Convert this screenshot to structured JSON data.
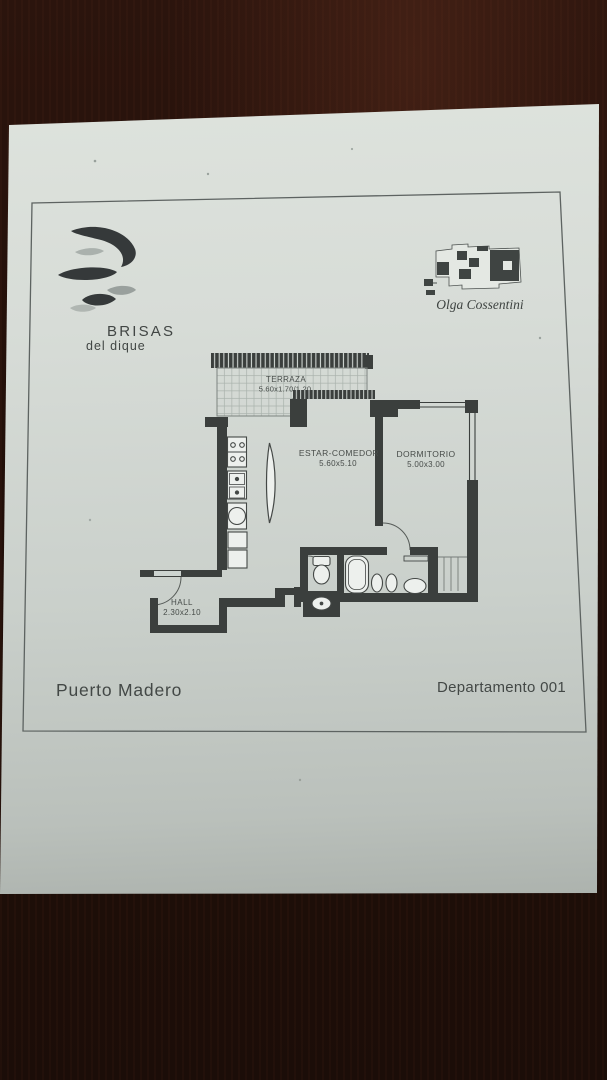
{
  "scene": {
    "description": "photograph of a printed floor-plan brochure page lying on a dark wood table",
    "paper_color_top": "#dee3dd",
    "paper_color_bottom": "#8f958f",
    "wood_color": "#22100a",
    "ink_color": "#3e4341"
  },
  "branding": {
    "logo_icon": "spiral-swirl-logo",
    "name": "BRISAS",
    "tagline": "del dique"
  },
  "architect": {
    "key_plan_icon": "building-footprint-key-plan",
    "name": "Olga Cossentini"
  },
  "floor_plan": {
    "rooms": [
      {
        "name": "TERRAZA",
        "dimensions": "5.60x1.70/1.20"
      },
      {
        "name": "ESTAR-COMEDOR",
        "dimensions": "5.60x5.10"
      },
      {
        "name": "DORMITORIO",
        "dimensions": "5.00x3.00"
      },
      {
        "name": "HALL",
        "dimensions": "2.30x2.10"
      }
    ],
    "fixtures": [
      "cooktop",
      "double-sink",
      "oven",
      "refrigerator",
      "curved-kitchen-door",
      "wc-toilet",
      "wc-washbasin",
      "bathtub",
      "toilet",
      "bidet",
      "vanity-basin",
      "bedroom-closet"
    ]
  },
  "footer": {
    "location": "Puerto Madero",
    "unit": "Departamento 001"
  }
}
